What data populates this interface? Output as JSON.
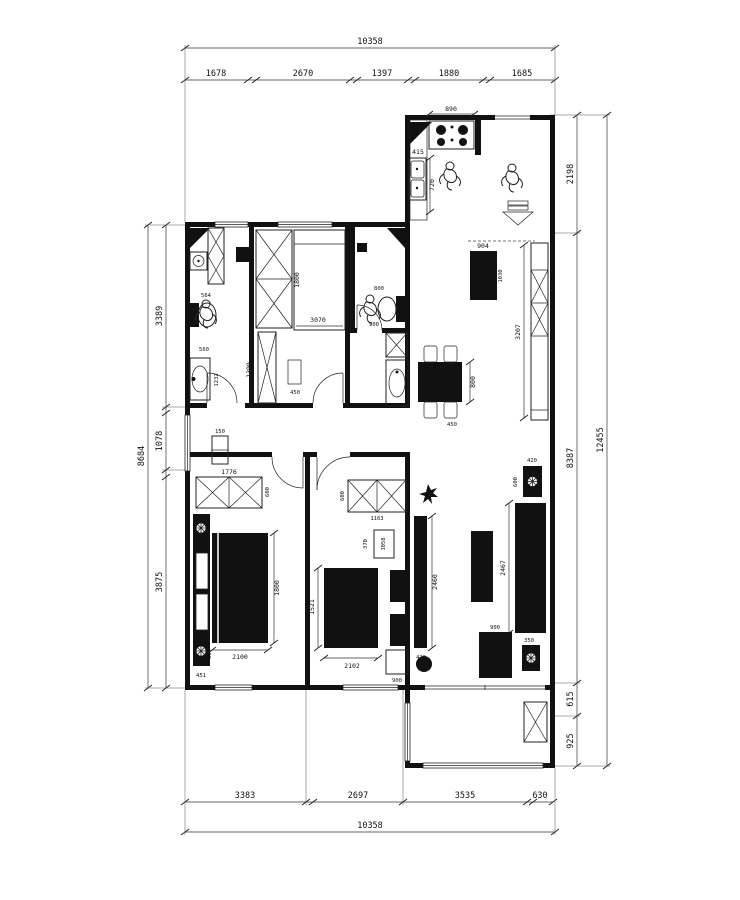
{
  "drawing": {
    "kind": "residential floor plan",
    "units": "mm"
  },
  "dims": {
    "top": {
      "total": "10358",
      "segments": [
        "1678",
        "2670",
        "1397",
        "1880",
        "1685"
      ]
    },
    "bottom": {
      "total": "10358",
      "segments": [
        "3383",
        "2697",
        "3535",
        "630"
      ]
    },
    "left": {
      "total": "8684",
      "segments": [
        "3389",
        "1078",
        "3875"
      ]
    },
    "right": {
      "total": "12455",
      "segments": [
        "2198",
        "8387",
        "615",
        "925"
      ]
    }
  },
  "rooms": {
    "kitchen": {
      "stove_width": "890",
      "stove_depth": "525",
      "sink_width": "415",
      "counter_depth": "720"
    },
    "bath_top": {
      "toilet_width": "564",
      "toilet_clear": "560",
      "basin_length": "1232"
    },
    "bedroom_top": {
      "wardrobe_height": "1800",
      "closet_height": "1399",
      "bed_length": "3070",
      "rug_width": "450"
    },
    "bath_mid": {
      "shower_width": "800",
      "toilet_clear": "900"
    },
    "dining": {
      "table_length": "800",
      "chair_width": "450"
    },
    "hall": {
      "cabinet_width": "150",
      "shoe_cabinet_length": "3207",
      "entry_cabinet_width": "904",
      "entry_cabinet_depth": "1030"
    },
    "bedroom_left": {
      "wardrobe_width": "1776",
      "wardrobe_depth": "600",
      "bed_width": "1800",
      "bed_length": "2100",
      "nightstand_width": "300",
      "wall_gap": "451"
    },
    "bedroom_mid": {
      "wardrobe_depth": "600",
      "wardrobe_width": "1163",
      "desk_depth": "370",
      "desk_length": "1058",
      "bed_width": "1521",
      "bed_length": "2102",
      "tv_stand_width": "900",
      "media_wall_length": "2460",
      "media_wall_depth": "420"
    },
    "living": {
      "side_table_width": "420",
      "side_table_depth": "600",
      "sofa_length": "2467",
      "side_table_b_width": "350",
      "cabinet_width": "900"
    }
  },
  "icons": {
    "person": "person-sketch",
    "plant": "plant",
    "arrow": "entry-direction-arrow",
    "lamp": "bedside-lamp"
  }
}
